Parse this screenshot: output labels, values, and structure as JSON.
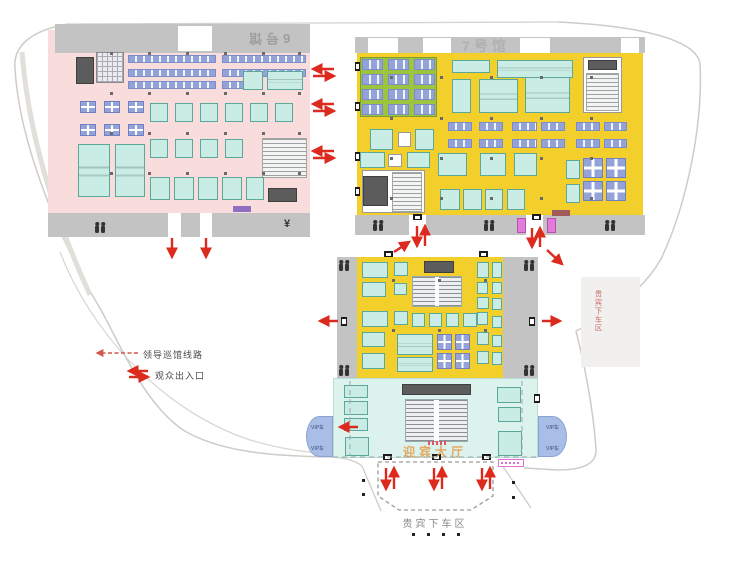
{
  "labels": {
    "hall6": "6号馆",
    "hall7": "7号馆",
    "welcome_hall": "迎宾大厅",
    "dropoff": "贵宾下车区",
    "roadside_vip": "贵宾下车区",
    "vip_lane": "VIP车",
    "legend_route": "领导巡馆线路",
    "legend_entrance": "观众出入口",
    "yen_icon": "¥"
  },
  "colors": {
    "hall6_floor": "#F8DDDC",
    "hall7_floor": "#F2CF2B",
    "welcome_floor": "#DCF2EC",
    "corridor": "#C3C3C3",
    "booth_cyan": "#C9EDE4",
    "booth_lavender": "#93A2D8",
    "booth_green": "#9CC43F",
    "booth_magenta": "#E27BD9",
    "arrow_red": "#DD2A1E",
    "vip_wedge": "#A9BEE6"
  },
  "rects": [
    [
      48,
      30,
      262,
      185,
      "pink",
      "hall6-floor"
    ],
    [
      55,
      24,
      255,
      29,
      "band",
      "corridor-band"
    ],
    [
      178,
      26,
      34,
      25,
      "wgap",
      "door-gap"
    ],
    [
      48,
      213,
      262,
      24,
      "band",
      "corridor-band"
    ],
    [
      168,
      213,
      13,
      24,
      "wgap",
      "door-gap"
    ],
    [
      200,
      213,
      12,
      24,
      "wgap",
      "door-gap"
    ],
    [
      357,
      53,
      286,
      162,
      "yellow",
      "hall7-floor"
    ],
    [
      355,
      37,
      290,
      16,
      "band",
      "corridor-band"
    ],
    [
      368,
      38,
      30,
      15,
      "wgap",
      "door-gap"
    ],
    [
      423,
      38,
      28,
      15,
      "wgap",
      "door-gap"
    ],
    [
      520,
      38,
      30,
      15,
      "wgap",
      "door-gap"
    ],
    [
      621,
      38,
      18,
      15,
      "wgap",
      "door-gap"
    ],
    [
      355,
      215,
      290,
      20,
      "band",
      "corridor-band"
    ],
    [
      409,
      215,
      17,
      20,
      "wgap",
      "door-gap"
    ],
    [
      526,
      215,
      17,
      20,
      "wgap",
      "door-gap"
    ],
    [
      337,
      257,
      20,
      121,
      "band",
      "corridor-band"
    ],
    [
      503,
      257,
      35,
      121,
      "band",
      "corridor-band"
    ],
    [
      357,
      257,
      146,
      121,
      "yellow",
      "mid-hall-floor"
    ],
    [
      333,
      378,
      205,
      80,
      "welcome",
      "welcome-hall-floor"
    ],
    [
      581,
      277,
      59,
      90,
      "gbox",
      "vip-gray-box"
    ],
    [
      76,
      57,
      18,
      27,
      "dark"
    ],
    [
      96,
      52,
      28,
      31,
      "grid"
    ],
    [
      128,
      55,
      88,
      8,
      "lav"
    ],
    [
      222,
      55,
      84,
      8,
      "lav"
    ],
    [
      128,
      69,
      88,
      8,
      "lav"
    ],
    [
      222,
      69,
      84,
      8,
      "lav"
    ],
    [
      128,
      81,
      88,
      8,
      "lav"
    ],
    [
      222,
      81,
      40,
      8,
      "lav"
    ],
    [
      243,
      71,
      20,
      19,
      "cyan"
    ],
    [
      267,
      71,
      36,
      19,
      "cyanL"
    ],
    [
      80,
      101,
      16,
      12,
      "lavc"
    ],
    [
      104,
      101,
      16,
      12,
      "lavc"
    ],
    [
      128,
      101,
      16,
      12,
      "lavc"
    ],
    [
      80,
      124,
      16,
      12,
      "lavc"
    ],
    [
      104,
      124,
      16,
      12,
      "lavc"
    ],
    [
      128,
      124,
      16,
      12,
      "lavc"
    ],
    [
      150,
      103,
      18,
      19,
      "cyan"
    ],
    [
      175,
      103,
      18,
      19,
      "cyan"
    ],
    [
      200,
      103,
      18,
      19,
      "cyan"
    ],
    [
      225,
      103,
      18,
      19,
      "cyan"
    ],
    [
      250,
      103,
      18,
      19,
      "cyan"
    ],
    [
      275,
      103,
      18,
      19,
      "cyan"
    ],
    [
      150,
      139,
      18,
      19,
      "cyan"
    ],
    [
      175,
      139,
      18,
      19,
      "cyan"
    ],
    [
      200,
      139,
      18,
      19,
      "cyan"
    ],
    [
      225,
      139,
      18,
      19,
      "cyan"
    ],
    [
      262,
      138,
      45,
      40,
      "hatch"
    ],
    [
      78,
      144,
      32,
      53,
      "cyanL"
    ],
    [
      115,
      144,
      30,
      53,
      "cyanL"
    ],
    [
      150,
      177,
      20,
      23,
      "cyan"
    ],
    [
      174,
      177,
      20,
      23,
      "cyan"
    ],
    [
      198,
      177,
      20,
      23,
      "cyan"
    ],
    [
      222,
      177,
      20,
      23,
      "cyan"
    ],
    [
      246,
      177,
      18,
      23,
      "cyan"
    ],
    [
      268,
      188,
      29,
      14,
      "dark"
    ],
    [
      233,
      206,
      18,
      6,
      "badgeP"
    ],
    [
      360,
      57,
      77,
      60,
      "green"
    ],
    [
      362,
      59,
      21,
      11,
      "lav"
    ],
    [
      388,
      59,
      21,
      11,
      "lav"
    ],
    [
      414,
      59,
      21,
      11,
      "lav"
    ],
    [
      362,
      74,
      21,
      11,
      "lav"
    ],
    [
      388,
      74,
      21,
      11,
      "lav"
    ],
    [
      414,
      74,
      21,
      11,
      "lav"
    ],
    [
      362,
      89,
      21,
      11,
      "lav"
    ],
    [
      388,
      89,
      21,
      11,
      "lav"
    ],
    [
      414,
      89,
      21,
      11,
      "lav"
    ],
    [
      362,
      104,
      21,
      11,
      "lav"
    ],
    [
      388,
      104,
      21,
      11,
      "lav"
    ],
    [
      414,
      104,
      21,
      11,
      "lav"
    ],
    [
      452,
      60,
      38,
      13,
      "cyan"
    ],
    [
      497,
      60,
      76,
      18,
      "cyanL"
    ],
    [
      452,
      79,
      19,
      34,
      "cyan"
    ],
    [
      479,
      79,
      39,
      34,
      "cyanL"
    ],
    [
      525,
      77,
      45,
      36,
      "cyanL"
    ],
    [
      583,
      57,
      39,
      56,
      "white"
    ],
    [
      588,
      60,
      29,
      10,
      "dark"
    ],
    [
      586,
      73,
      33,
      38,
      "hatch"
    ],
    [
      370,
      129,
      23,
      21,
      "cyan"
    ],
    [
      398,
      132,
      13,
      15,
      "white"
    ],
    [
      415,
      129,
      19,
      21,
      "cyan"
    ],
    [
      448,
      122,
      24,
      9,
      "lav"
    ],
    [
      479,
      122,
      24,
      9,
      "lav"
    ],
    [
      512,
      122,
      25,
      9,
      "lav"
    ],
    [
      541,
      122,
      24,
      9,
      "lav"
    ],
    [
      576,
      122,
      24,
      9,
      "lav"
    ],
    [
      604,
      122,
      23,
      9,
      "lav"
    ],
    [
      448,
      139,
      24,
      9,
      "lav"
    ],
    [
      479,
      139,
      24,
      9,
      "lav"
    ],
    [
      512,
      139,
      25,
      9,
      "lav"
    ],
    [
      541,
      139,
      24,
      9,
      "lav"
    ],
    [
      576,
      139,
      24,
      9,
      "lav"
    ],
    [
      604,
      139,
      23,
      9,
      "lav"
    ],
    [
      360,
      152,
      25,
      16,
      "cyan"
    ],
    [
      388,
      154,
      14,
      13,
      "white"
    ],
    [
      407,
      152,
      23,
      16,
      "cyan"
    ],
    [
      362,
      170,
      63,
      43,
      "white"
    ],
    [
      363,
      176,
      25,
      30,
      "dark"
    ],
    [
      392,
      172,
      30,
      40,
      "hatch"
    ],
    [
      438,
      153,
      29,
      23,
      "cyan"
    ],
    [
      480,
      153,
      26,
      23,
      "cyan"
    ],
    [
      514,
      153,
      23,
      23,
      "cyan"
    ],
    [
      440,
      189,
      20,
      21,
      "cyan"
    ],
    [
      463,
      189,
      19,
      21,
      "cyan"
    ],
    [
      485,
      189,
      18,
      21,
      "cyan"
    ],
    [
      507,
      189,
      18,
      21,
      "cyan"
    ],
    [
      566,
      160,
      14,
      19,
      "cyan"
    ],
    [
      566,
      184,
      14,
      19,
      "cyan"
    ],
    [
      583,
      158,
      20,
      20,
      "lavc"
    ],
    [
      606,
      158,
      20,
      20,
      "lavc"
    ],
    [
      583,
      181,
      20,
      20,
      "lavc"
    ],
    [
      606,
      181,
      20,
      20,
      "lavc"
    ],
    [
      552,
      210,
      18,
      6,
      "badgeR"
    ],
    [
      517,
      218,
      9,
      15,
      "mag"
    ],
    [
      547,
      218,
      9,
      15,
      "mag"
    ],
    [
      362,
      262,
      26,
      16,
      "cyan"
    ],
    [
      362,
      282,
      24,
      15,
      "cyan"
    ],
    [
      362,
      311,
      26,
      16,
      "cyan"
    ],
    [
      362,
      332,
      23,
      15,
      "cyan"
    ],
    [
      362,
      353,
      23,
      16,
      "cyan"
    ],
    [
      394,
      262,
      14,
      14,
      "cyan"
    ],
    [
      394,
      283,
      13,
      12,
      "cyan"
    ],
    [
      394,
      311,
      14,
      14,
      "cyan"
    ],
    [
      424,
      261,
      30,
      12,
      "dark"
    ],
    [
      412,
      276,
      50,
      31,
      "seat"
    ],
    [
      412,
      313,
      13,
      14,
      "cyan"
    ],
    [
      429,
      313,
      13,
      14,
      "cyan"
    ],
    [
      446,
      313,
      13,
      14,
      "cyan"
    ],
    [
      463,
      313,
      14,
      14,
      "cyan"
    ],
    [
      477,
      262,
      12,
      16,
      "cyan"
    ],
    [
      477,
      282,
      11,
      12,
      "cyan"
    ],
    [
      477,
      297,
      12,
      12,
      "cyan"
    ],
    [
      477,
      312,
      11,
      13,
      "cyan"
    ],
    [
      477,
      332,
      12,
      13,
      "cyan"
    ],
    [
      477,
      351,
      12,
      13,
      "cyan"
    ],
    [
      492,
      262,
      10,
      16,
      "cyan"
    ],
    [
      492,
      282,
      10,
      12,
      "cyan"
    ],
    [
      492,
      298,
      10,
      12,
      "cyan"
    ],
    [
      492,
      316,
      10,
      12,
      "cyan"
    ],
    [
      492,
      335,
      10,
      12,
      "cyan"
    ],
    [
      492,
      352,
      10,
      13,
      "cyan"
    ],
    [
      397,
      334,
      36,
      21,
      "cyanL"
    ],
    [
      397,
      357,
      36,
      15,
      "cyanL"
    ],
    [
      437,
      334,
      15,
      16,
      "lavc"
    ],
    [
      455,
      334,
      15,
      16,
      "lavc"
    ],
    [
      437,
      353,
      15,
      16,
      "lavc"
    ],
    [
      455,
      353,
      15,
      16,
      "lavc"
    ],
    [
      344,
      385,
      24,
      13,
      "cyan"
    ],
    [
      344,
      401,
      24,
      14,
      "cyan"
    ],
    [
      344,
      418,
      24,
      13,
      "cyan"
    ],
    [
      345,
      437,
      24,
      19,
      "cyan"
    ],
    [
      497,
      387,
      24,
      16,
      "cyan"
    ],
    [
      498,
      407,
      23,
      15,
      "cyan"
    ],
    [
      498,
      431,
      24,
      25,
      "cyan"
    ],
    [
      402,
      384,
      69,
      11,
      "dark"
    ],
    [
      405,
      399,
      63,
      43,
      "seat"
    ],
    [
      428,
      441,
      18,
      4,
      "microred"
    ],
    [
      498,
      459,
      26,
      8,
      "badgeO"
    ]
  ],
  "doors": [
    [
      413,
      214,
      9,
      6
    ],
    [
      532,
      214,
      9,
      6
    ],
    [
      384,
      251,
      9,
      6
    ],
    [
      479,
      251,
      9,
      6
    ],
    [
      341,
      317,
      6,
      9
    ],
    [
      529,
      317,
      6,
      9
    ],
    [
      383,
      454,
      9,
      6
    ],
    [
      432,
      454,
      9,
      6
    ],
    [
      482,
      454,
      9,
      6
    ],
    [
      534,
      394,
      6,
      9
    ],
    [
      355,
      62,
      5,
      9
    ],
    [
      355,
      102,
      5,
      9
    ],
    [
      355,
      152,
      5,
      9
    ],
    [
      355,
      187,
      5,
      9
    ]
  ],
  "wc_icons": [
    [
      95,
      222
    ],
    [
      373,
      220
    ],
    [
      484,
      220
    ],
    [
      605,
      220
    ],
    [
      339,
      260
    ],
    [
      339,
      365
    ],
    [
      524,
      260
    ],
    [
      524,
      365
    ]
  ],
  "columns": [
    {
      "xs": [
        110,
        148,
        186,
        224,
        262,
        298
      ],
      "ys": [
        52,
        92,
        132,
        172
      ]
    },
    {
      "xs": [
        390,
        440,
        490,
        540,
        590
      ],
      "ys": [
        76,
        117,
        157,
        197
      ]
    },
    {
      "xs": [
        392,
        438,
        484
      ],
      "ys": [
        279,
        329
      ]
    }
  ],
  "black_dots": [
    [
      362,
      479
    ],
    [
      362,
      493
    ],
    [
      512,
      481
    ],
    [
      512,
      496
    ],
    [
      412,
      533
    ],
    [
      427,
      533
    ],
    [
      442,
      533
    ],
    [
      457,
      533
    ]
  ],
  "arrows": [
    {
      "p": [
        334,
        69,
        313,
        69
      ]
    },
    {
      "p": [
        313,
        76,
        334,
        76
      ]
    },
    {
      "p": [
        334,
        104,
        313,
        104
      ]
    },
    {
      "p": [
        313,
        111,
        334,
        111
      ]
    },
    {
      "p": [
        334,
        151,
        313,
        151
      ]
    },
    {
      "p": [
        313,
        158,
        334,
        158
      ]
    },
    {
      "p": [
        172,
        238,
        172,
        257
      ]
    },
    {
      "p": [
        206,
        238,
        206,
        257
      ]
    },
    {
      "p": [
        417,
        226,
        417,
        246
      ]
    },
    {
      "p": [
        425,
        246,
        425,
        226
      ]
    },
    {
      "p": [
        532,
        228,
        532,
        247
      ]
    },
    {
      "p": [
        540,
        247,
        540,
        228
      ]
    },
    {
      "p": [
        394,
        252,
        409,
        242
      ]
    },
    {
      "p": [
        547,
        250,
        562,
        264
      ]
    },
    {
      "p": [
        338,
        321,
        320,
        321
      ]
    },
    {
      "p": [
        542,
        321,
        560,
        321
      ]
    },
    {
      "p": [
        358,
        427,
        340,
        427
      ]
    },
    {
      "p": [
        386,
        468,
        386,
        489
      ]
    },
    {
      "p": [
        394,
        489,
        394,
        468
      ]
    },
    {
      "p": [
        434,
        468,
        434,
        489
      ]
    },
    {
      "p": [
        442,
        489,
        442,
        468
      ]
    },
    {
      "p": [
        482,
        468,
        482,
        489
      ]
    },
    {
      "p": [
        490,
        489,
        490,
        468
      ]
    },
    {
      "p": [
        138,
        353,
        97,
        353
      ],
      "dashed": true
    },
    {
      "p": [
        148,
        371,
        129,
        371
      ]
    },
    {
      "p": [
        129,
        377,
        148,
        377
      ]
    }
  ],
  "dropoff_polygon": "378,462 493,462 493,496 471,510 399,510 378,496",
  "dashed_lines": [
    [
      350,
      381,
      350,
      455
    ],
    [
      522,
      381,
      522,
      455
    ],
    [
      333,
      457,
      538,
      457
    ]
  ]
}
